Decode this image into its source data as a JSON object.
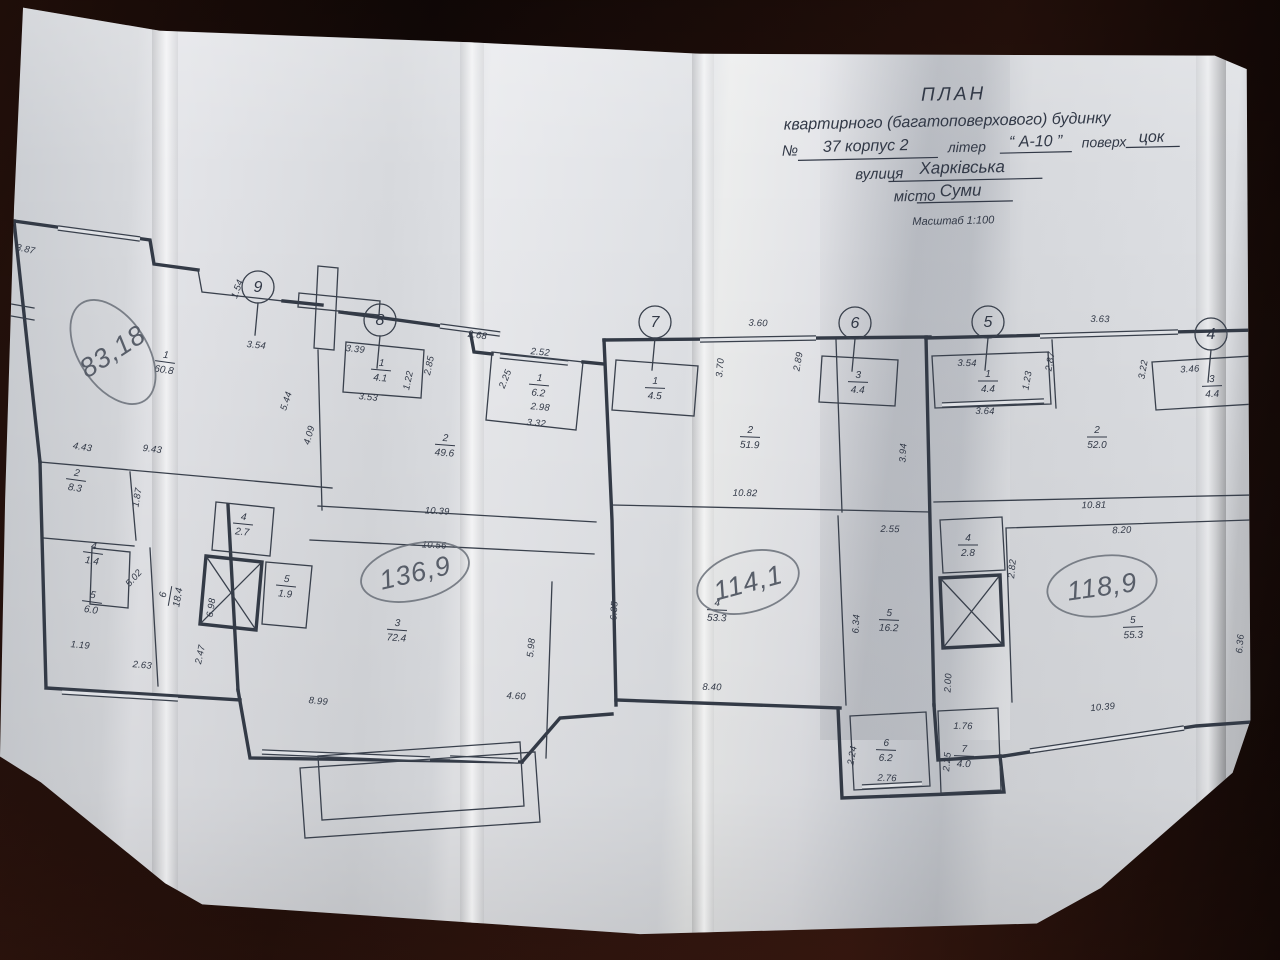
{
  "colors": {
    "ink": "#323947",
    "paper": "#dcdde1",
    "pencil": "#5d626c",
    "table": "#1a0d0a"
  },
  "title_block": {
    "title": "ПЛАН",
    "subtitle": "квартирного (багатоповерхового) будинку",
    "no_label": "№",
    "number_value": "37 корпус 2",
    "liter_label": "літер",
    "liter_value": "“ А-10 ”",
    "floor_label": "поверх",
    "floor_value": "цок",
    "street_label": "вулиця",
    "street_value": "Харківська",
    "city_label": "місто",
    "city_value": "Суми",
    "scale": "Масштаб 1:100"
  },
  "axes": [
    {
      "n": "9",
      "x": 258,
      "y": 287
    },
    {
      "n": "8",
      "x": 380,
      "y": 320
    },
    {
      "n": "7",
      "x": 655,
      "y": 322
    },
    {
      "n": "6",
      "x": 855,
      "y": 323
    },
    {
      "n": "5",
      "x": 988,
      "y": 322
    },
    {
      "n": "4",
      "x": 1211,
      "y": 334
    }
  ],
  "handwritten_areas": [
    {
      "t": "83,18",
      "x": 113,
      "y": 352,
      "r": -33,
      "rx": 34,
      "ry": 58,
      "fs": 24
    },
    {
      "t": "136,9",
      "x": 415,
      "y": 572,
      "r": -13,
      "rx": 55,
      "ry": 28,
      "fs": 28
    },
    {
      "t": "114,1",
      "x": 748,
      "y": 582,
      "r": -15,
      "rx": 52,
      "ry": 30,
      "fs": 28
    },
    {
      "t": "118,9",
      "x": 1102,
      "y": 586,
      "r": -8,
      "rx": 55,
      "ry": 30,
      "fs": 28
    }
  ],
  "rooms": [
    {
      "n": "1",
      "a": "60.8",
      "x": 165,
      "y": 362,
      "r": 8
    },
    {
      "n": "2",
      "a": "8.3",
      "x": 76,
      "y": 480,
      "r": 8
    },
    {
      "n": "4",
      "a": "1.4",
      "x": 93,
      "y": 553,
      "r": 8
    },
    {
      "n": "5",
      "a": "6.0",
      "x": 92,
      "y": 602,
      "r": 8
    },
    {
      "n": "6",
      "a": "18.4",
      "x": 170,
      "y": 596,
      "r": -80
    },
    {
      "n": "4",
      "a": "2.7",
      "x": 243,
      "y": 524,
      "r": 6
    },
    {
      "n": "5",
      "a": "1.9",
      "x": 286,
      "y": 586,
      "r": 6
    },
    {
      "n": "3",
      "a": "72.4",
      "x": 397,
      "y": 630,
      "r": 4
    },
    {
      "n": "1",
      "a": "4.1",
      "x": 381,
      "y": 370,
      "r": 5
    },
    {
      "n": "2",
      "a": "49.6",
      "x": 445,
      "y": 445,
      "r": 4
    },
    {
      "n": "1",
      "a": "6.2",
      "x": 539,
      "y": 385,
      "r": 5
    },
    {
      "n": "1",
      "a": "4.5",
      "x": 655,
      "y": 388,
      "r": 2
    },
    {
      "n": "2",
      "a": "51.9",
      "x": 750,
      "y": 437,
      "r": 2
    },
    {
      "n": "3",
      "a": "4.4",
      "x": 858,
      "y": 382,
      "r": 2
    },
    {
      "n": "4",
      "a": "53.3",
      "x": 717,
      "y": 610,
      "r": 2
    },
    {
      "n": "5",
      "a": "16.2",
      "x": 889,
      "y": 620,
      "r": 2
    },
    {
      "n": "6",
      "a": "6.2",
      "x": 886,
      "y": 750,
      "r": 2
    },
    {
      "n": "7",
      "a": "4.0",
      "x": 964,
      "y": 756,
      "r": 2
    },
    {
      "n": "1",
      "a": "4.4",
      "x": 988,
      "y": 381,
      "r": 0
    },
    {
      "n": "2",
      "a": "52.0",
      "x": 1097,
      "y": 437,
      "r": 0
    },
    {
      "n": "3",
      "a": "4.4",
      "x": 1212,
      "y": 386,
      "r": -2
    },
    {
      "n": "4",
      "a": "2.8",
      "x": 968,
      "y": 545,
      "r": 0
    },
    {
      "n": "5",
      "a": "55.3",
      "x": 1133,
      "y": 627,
      "r": -2
    }
  ],
  "dimensions": [
    {
      "t": "3.87",
      "x": 25,
      "y": 252,
      "r": 12
    },
    {
      "t": "1.54",
      "x": 240,
      "y": 290,
      "r": -70
    },
    {
      "t": "3.54",
      "x": 256,
      "y": 348,
      "r": 6
    },
    {
      "t": "5.44",
      "x": 289,
      "y": 402,
      "r": -72
    },
    {
      "t": "4.09",
      "x": 312,
      "y": 436,
      "r": -74
    },
    {
      "t": "4.43",
      "x": 82,
      "y": 450,
      "r": 9
    },
    {
      "t": "9.43",
      "x": 152,
      "y": 452,
      "r": 7
    },
    {
      "t": "1.87",
      "x": 140,
      "y": 498,
      "r": -80
    },
    {
      "t": "5.02",
      "x": 136,
      "y": 580,
      "r": -48
    },
    {
      "t": "1.19",
      "x": 80,
      "y": 648,
      "r": 5
    },
    {
      "t": "2.63",
      "x": 142,
      "y": 668,
      "r": 5
    },
    {
      "t": "2.47",
      "x": 203,
      "y": 655,
      "r": -78
    },
    {
      "t": "6.98",
      "x": 214,
      "y": 608,
      "r": -82
    },
    {
      "t": "8.99",
      "x": 318,
      "y": 704,
      "r": 6
    },
    {
      "t": "4.60",
      "x": 516,
      "y": 699,
      "r": 3
    },
    {
      "t": "5.98",
      "x": 534,
      "y": 648,
      "r": -84
    },
    {
      "t": "10.39",
      "x": 437,
      "y": 514,
      "r": 3
    },
    {
      "t": "10.56",
      "x": 434,
      "y": 548,
      "r": 3
    },
    {
      "t": "3.39",
      "x": 355,
      "y": 352,
      "r": 6
    },
    {
      "t": "3.53",
      "x": 368,
      "y": 400,
      "r": 6
    },
    {
      "t": "1.22",
      "x": 411,
      "y": 381,
      "r": -78
    },
    {
      "t": "2.85",
      "x": 432,
      "y": 366,
      "r": -78
    },
    {
      "t": "2.68",
      "x": 477,
      "y": 338,
      "r": 8
    },
    {
      "t": "2.52",
      "x": 540,
      "y": 355,
      "r": 5
    },
    {
      "t": "2.25",
      "x": 508,
      "y": 380,
      "r": -68
    },
    {
      "t": "2.98",
      "x": 540,
      "y": 410,
      "r": 5
    },
    {
      "t": "3.32",
      "x": 536,
      "y": 426,
      "r": 5
    },
    {
      "t": "3.60",
      "x": 758,
      "y": 326,
      "r": 2
    },
    {
      "t": "3.70",
      "x": 723,
      "y": 368,
      "r": -85
    },
    {
      "t": "2.89",
      "x": 801,
      "y": 362,
      "r": -80
    },
    {
      "t": "10.82",
      "x": 745,
      "y": 496,
      "r": 1
    },
    {
      "t": "6.35",
      "x": 617,
      "y": 611,
      "r": -86
    },
    {
      "t": "8.40",
      "x": 712,
      "y": 690,
      "r": 1
    },
    {
      "t": "2.55",
      "x": 890,
      "y": 532,
      "r": 1
    },
    {
      "t": "6.34",
      "x": 859,
      "y": 624,
      "r": -87
    },
    {
      "t": "2.24",
      "x": 855,
      "y": 756,
      "r": -80
    },
    {
      "t": "2.76",
      "x": 887,
      "y": 781,
      "r": 2
    },
    {
      "t": "1.76",
      "x": 963,
      "y": 729,
      "r": 1
    },
    {
      "t": "2.25",
      "x": 950,
      "y": 762,
      "r": -85
    },
    {
      "t": "3.54",
      "x": 967,
      "y": 366,
      "r": 1
    },
    {
      "t": "3.64",
      "x": 985,
      "y": 414,
      "r": 1
    },
    {
      "t": "1.23",
      "x": 1030,
      "y": 381,
      "r": -80
    },
    {
      "t": "2.87",
      "x": 1053,
      "y": 362,
      "r": -80
    },
    {
      "t": "3.63",
      "x": 1100,
      "y": 322,
      "r": 1
    },
    {
      "t": "3.94",
      "x": 906,
      "y": 453,
      "r": -87
    },
    {
      "t": "10.81",
      "x": 1094,
      "y": 508,
      "r": -1
    },
    {
      "t": "3.22",
      "x": 1146,
      "y": 370,
      "r": -80
    },
    {
      "t": "3.46",
      "x": 1190,
      "y": 372,
      "r": -3
    },
    {
      "t": "1.26",
      "x": 1261,
      "y": 386,
      "r": -85
    },
    {
      "t": "3.63",
      "x": 1263,
      "y": 467,
      "r": -85
    },
    {
      "t": "2.82",
      "x": 1015,
      "y": 569,
      "r": -85
    },
    {
      "t": "8.20",
      "x": 1122,
      "y": 533,
      "r": -2
    },
    {
      "t": "6.36",
      "x": 1243,
      "y": 644,
      "r": -85
    },
    {
      "t": "2.00",
      "x": 951,
      "y": 683,
      "r": -87
    },
    {
      "t": "10.39",
      "x": 1103,
      "y": 710,
      "r": -5
    }
  ]
}
